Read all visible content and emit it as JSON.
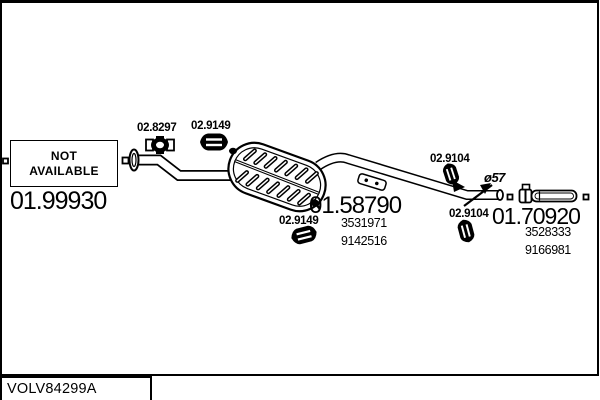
{
  "diagram": {
    "code_box": "VOLV84299A",
    "not_available": {
      "line1": "NOT",
      "line2": "AVAILABLE"
    },
    "front_pipe_ref": "01.99930",
    "clamp_ref": "02.8297",
    "hanger_top_ref": "02.9149",
    "hanger_middle_ref": "02.9149",
    "silencer_ref": "01.58790",
    "silencer_oe": [
      "3531971",
      "9142516"
    ],
    "hanger_right_top_ref": "02.9104",
    "hanger_right_bottom_ref": "02.9104",
    "diameter_label": "ø57",
    "tail_ref": "01.70920",
    "tail_oe": [
      "3528333",
      "9166981"
    ]
  },
  "colors": {
    "ink": "#000000",
    "paper": "#ffffff"
  }
}
